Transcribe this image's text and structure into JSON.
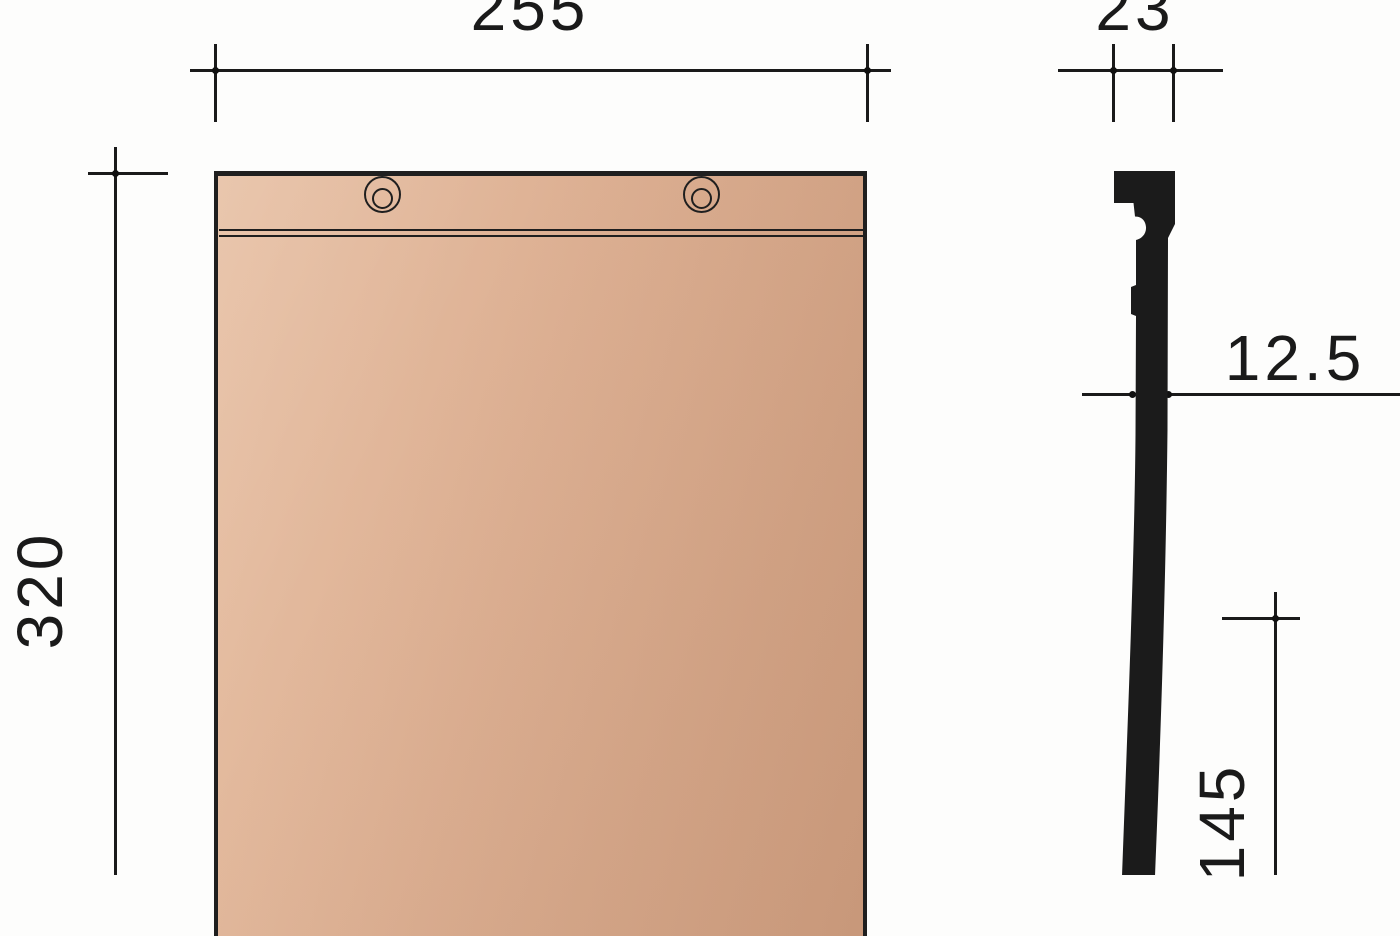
{
  "labels": {
    "overall_width_mm": "255",
    "head_depth_mm": "23",
    "overall_length_mm": "320",
    "thickness_mm": "12.5",
    "lower_section_mm": "145"
  },
  "front_view": {
    "nail_hole_count": 2,
    "head_lines": 2
  },
  "colors": {
    "linework": "#1a1a1a",
    "profile_silhouette": "#1b1b1b",
    "tile_surface_light": "#e7c0a4",
    "tile_surface_mid": "#ddb093",
    "tile_surface_dark": "#d1a183"
  }
}
